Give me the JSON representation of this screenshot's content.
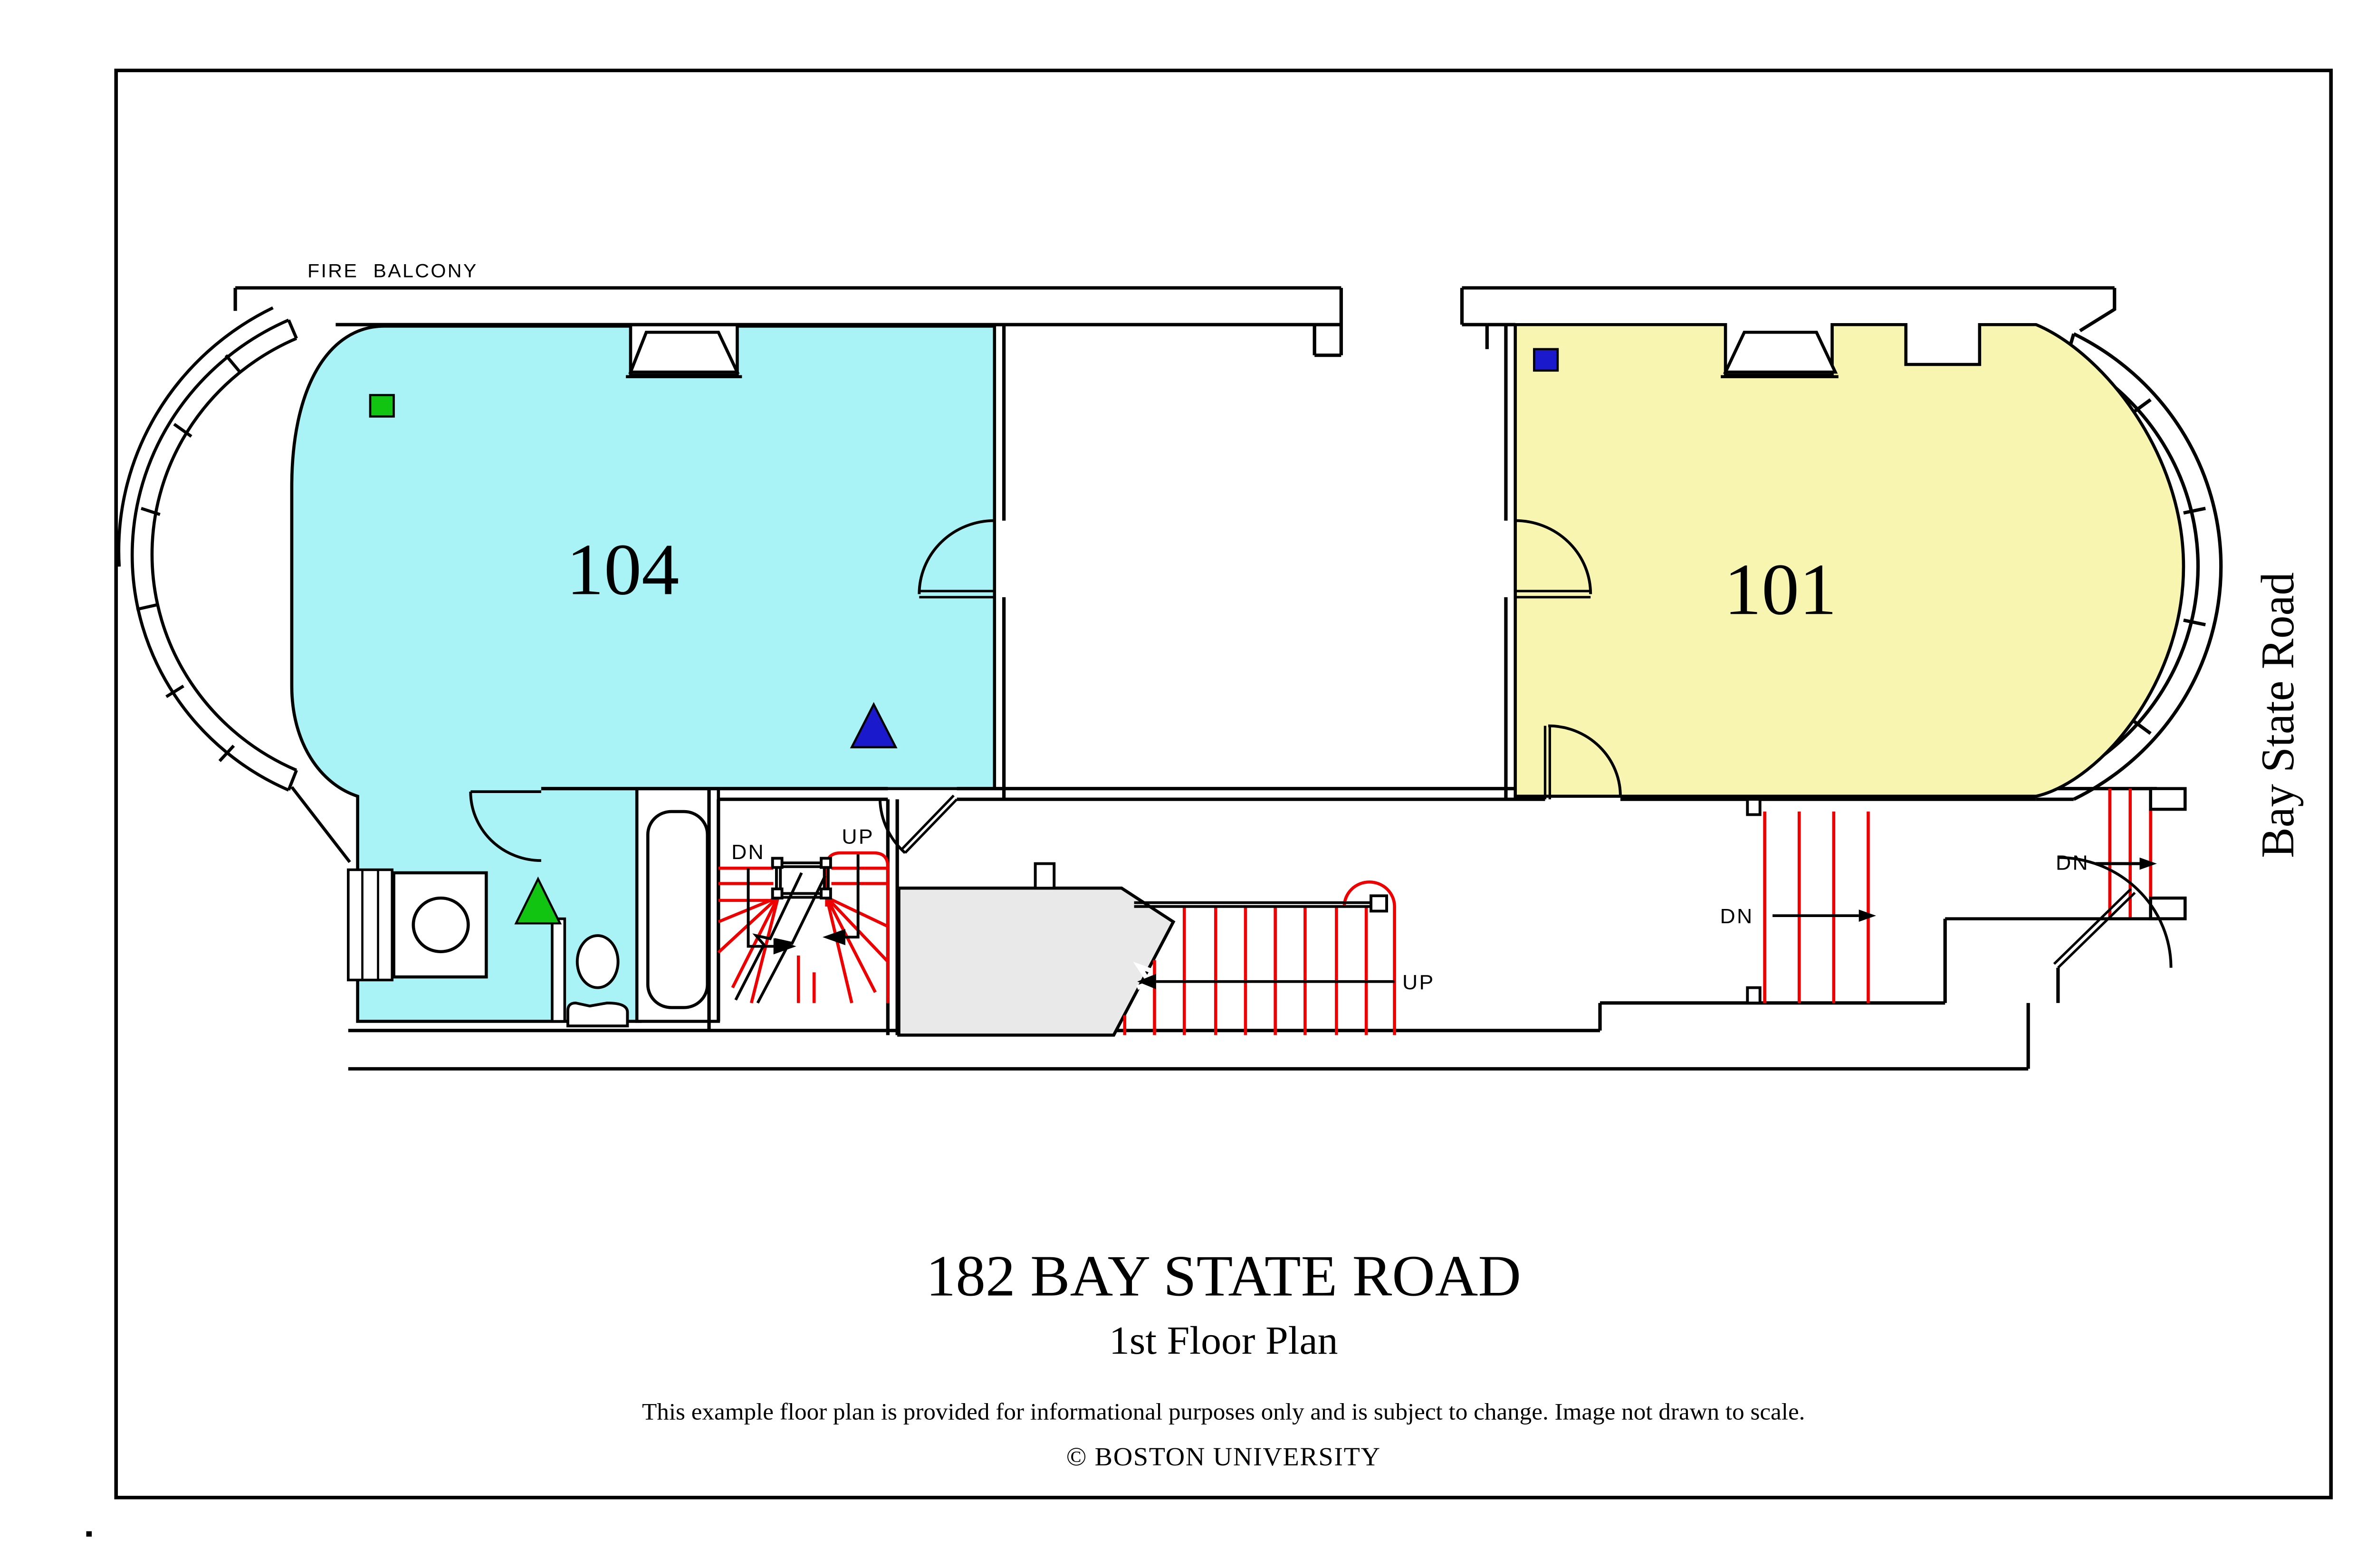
{
  "title_block": {
    "address": "182 BAY STATE ROAD",
    "floor": "1st Floor Plan",
    "disclaimer": "This example floor plan is provided for informational purposes only and is subject to change. Image not drawn to scale.",
    "copyright": "© BOSTON UNIVERSITY"
  },
  "street_label": "Bay State Road",
  "labels": {
    "fire_balcony": "FIRE BALCONY",
    "up": "UP",
    "dn": "DN"
  },
  "rooms": [
    {
      "number": "104",
      "fill": "#a9f3f6"
    },
    {
      "number": "101",
      "fill": "#f7f5af"
    }
  ],
  "markers": [
    {
      "name": "green-square",
      "room": "104",
      "color": "#12c412"
    },
    {
      "name": "blue-triangle",
      "room": "104",
      "color": "#1a1acc"
    },
    {
      "name": "green-triangle",
      "room": "bathroom",
      "color": "#12c412"
    },
    {
      "name": "blue-square",
      "room": "101",
      "color": "#1a1acc"
    }
  ],
  "colors": {
    "room104_fill": "#a9f3f6",
    "room101_fill": "#f7f5af",
    "landing_fill": "#e9e9e9",
    "stair_red": "#ee0000",
    "line_black": "#000000",
    "marker_green": "#12c412",
    "marker_blue": "#1a1acc"
  }
}
